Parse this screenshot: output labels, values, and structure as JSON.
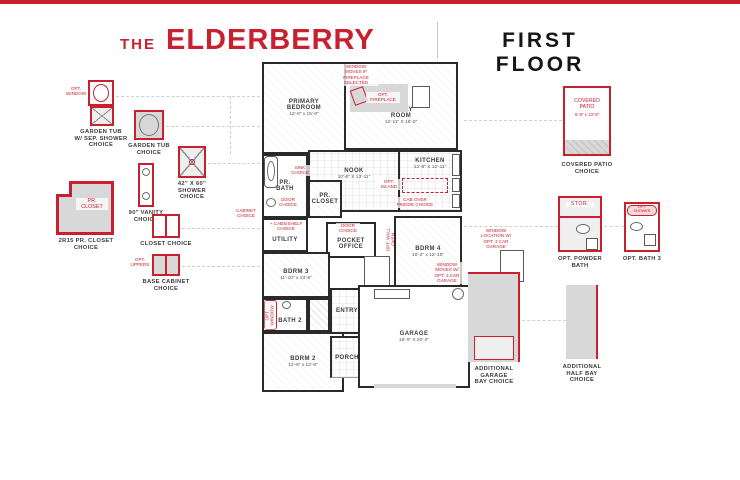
{
  "colors": {
    "accent_red": "#C8202E",
    "wall_black": "#2A2A2A",
    "shade_gray": "#D8D8D8"
  },
  "header": {
    "the": "THE",
    "name": "ELDERBERRY",
    "floor": "FIRST FLOOR"
  },
  "plan": {
    "rooms": {
      "primary": {
        "name": "PRIMARY\nBEDROOM",
        "dims": "12'-8\" x 15'-0\""
      },
      "family": {
        "name": "FAMILY\nROOM",
        "dims": "12'-11\" X 18'-0\""
      },
      "kitchen": {
        "name": "KITCHEN",
        "dims": "13'-8\" X 12'-11\""
      },
      "nook": {
        "name": "NOOK",
        "dims": "10'-8\" X 13'-11\""
      },
      "pr_bath": {
        "name": "PR.\nBATH"
      },
      "pr_closet": {
        "name": "PR.\nCLOSET"
      },
      "utility": {
        "name": "UTILITY"
      },
      "pocket_office": {
        "name": "POCKET\nOFFICE"
      },
      "bdrm4": {
        "name": "BDRM 4",
        "dims": "10'-2\" x 12'-10\""
      },
      "bdrm3": {
        "name": "BDRM 3",
        "dims": "11'-10\" x 13'-8\""
      },
      "bath2": {
        "name": "BATH 2"
      },
      "bdrm2": {
        "name": "BDRM 2",
        "dims": "12'-6\" x 13'-8\""
      },
      "entry": {
        "name": "ENTRY"
      },
      "porch": {
        "name": "PORCH"
      },
      "garage": {
        "name": "GARAGE",
        "dims": "19'-0\" X 20'-0\""
      }
    },
    "annotations": {
      "fireplace_window_note": "WINDOW\nMOVES IF\nFIREPLACE\nSELECTED",
      "opt_fireplace": "OPT.\nFIREPLACE",
      "opt_island": "OPT.\nISLAND",
      "cab_over_fridge": "CAB OVER\nFRIDGE CHOICE",
      "sink_choice": "SINK\nCHOICE",
      "door_choice_bath": "DOOR\nCHOICE",
      "cabinet_choice": "CABINET\nCHOICE",
      "cabs_shelf_choice": "+ CABS/SHELF\nCHOICE",
      "door_choice_office": "DOOR\nCHOICE",
      "opt_wall_oven": "OPT. WALL OVEN",
      "opt_window_bath2": "OPT. WINDOW",
      "bdrm4_window_note": "WINDOW\nMOVES W/\nOPT. 3 CAR\nGARAGE",
      "garage_window_note": "WINDOW\nLOCATION W/\nOPT. 3 CAR\nGARAGE",
      "door_choice_garage": "DOOR\nCHOICE"
    }
  },
  "left_options": {
    "garden_tub_sep_shower": {
      "caption": "GARDEN TUB\nW/ SEP. SHOWER\nCHOICE",
      "note": "OPT.\nWINDOW"
    },
    "garden_tub": {
      "caption": "GARDEN TUB\nCHOICE"
    },
    "shower_42x60": {
      "caption": "42\" X 60\"\nSHOWER\nCHOICE"
    },
    "vanity_90": {
      "caption": "90\" VANITY\nCHOICE"
    },
    "pr_closet": {
      "room_label": "PR.\nCLOSET",
      "caption": "2R15 PR. CLOSET\nCHOICE"
    },
    "closet": {
      "caption": "CLOSET CHOICE"
    },
    "base_cabinet": {
      "caption": "BASE CABINET\nCHOICE",
      "note": "OPT.\nUPPERS"
    }
  },
  "right_options": {
    "covered_patio": {
      "room_label": "COVERED\nPATIO",
      "dims": "6'-8\" x 13'-8\"",
      "caption": "COVERED PATIO\nCHOICE"
    },
    "powder_bath": {
      "stor_label": "STOR.",
      "caption": "OPT. POWDER\nBATH"
    },
    "bath3": {
      "note": "OPT.\nSHOWER",
      "caption": "OPT. BATH 3"
    },
    "additional_garage_bay": {
      "caption": "ADDITIONAL\nGARAGE\nBAY CHOICE"
    },
    "additional_half_bay": {
      "caption": "ADDITIONAL\nHALF BAY\nCHOICE"
    }
  }
}
